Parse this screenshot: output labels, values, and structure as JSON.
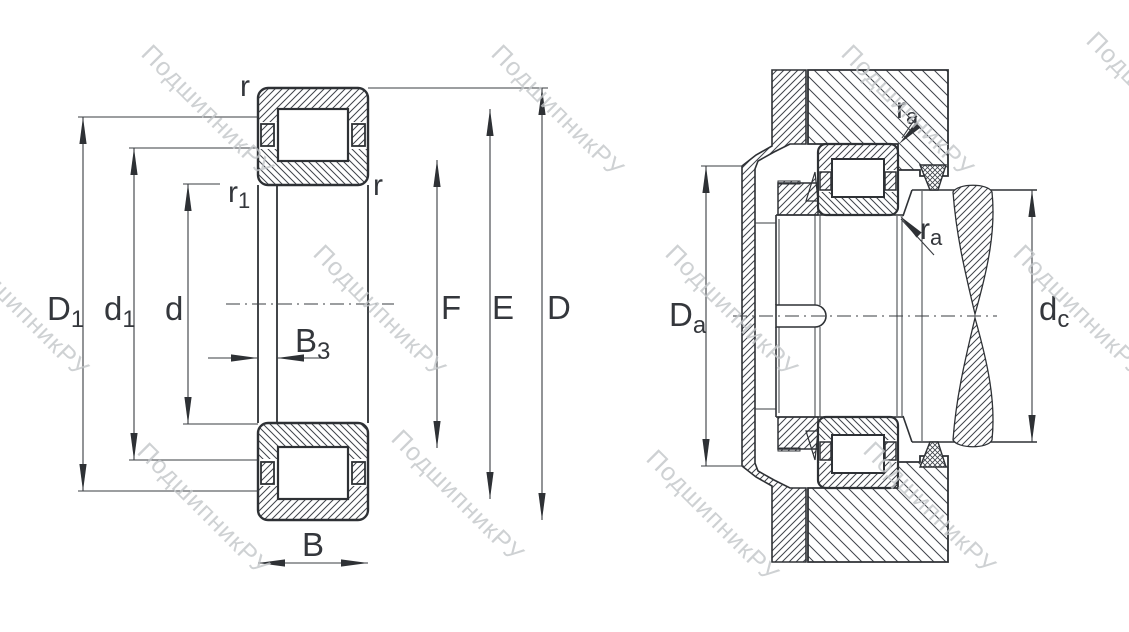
{
  "drawing": {
    "type": "bearing-technical-drawing",
    "watermark": {
      "text": "ПодшипникРУ",
      "color": "#c3c6c9"
    },
    "colors": {
      "background": "#ffffff",
      "outline": "#2e3135",
      "thin_line": "#3a3d42",
      "hatch": "#3f434a",
      "label": "#34373c"
    },
    "left_view": {
      "description": "bearing cross-section",
      "dims": {
        "D1": {
          "main": "D",
          "sub": "1"
        },
        "d1": {
          "main": "d",
          "sub": "1"
        },
        "d": {
          "main": "d"
        },
        "B3": {
          "main": "B",
          "sub": "3"
        },
        "B": {
          "main": "B"
        },
        "F": {
          "main": "F"
        },
        "E": {
          "main": "E"
        },
        "D": {
          "main": "D"
        },
        "r_top": {
          "main": "r"
        },
        "r1": {
          "main": "r",
          "sub": "1"
        },
        "r_inner": {
          "main": "r"
        }
      }
    },
    "right_view": {
      "description": "mounted bearing arrangement",
      "dims": {
        "Da": {
          "main": "D",
          "sub": "a"
        },
        "dc": {
          "main": "d",
          "sub": "c"
        },
        "ra_upper": {
          "main": "r",
          "sub": "a"
        },
        "ra_lower": {
          "main": "r",
          "sub": "a"
        }
      }
    }
  }
}
